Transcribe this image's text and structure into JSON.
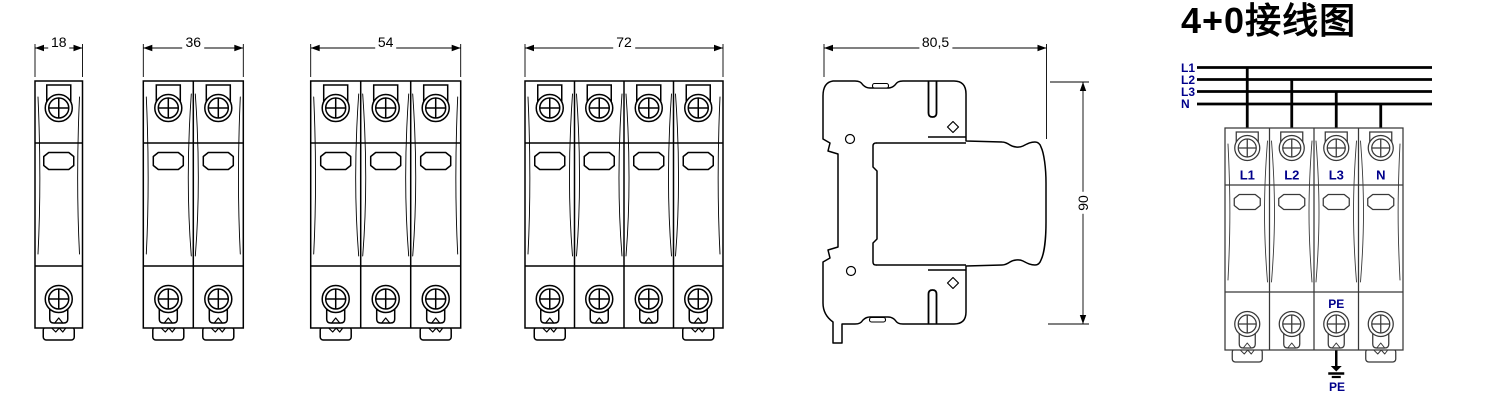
{
  "figure": {
    "front_views": [
      {
        "poles": 1,
        "width_mm": "18"
      },
      {
        "poles": 2,
        "width_mm": "36"
      },
      {
        "poles": 3,
        "width_mm": "54"
      },
      {
        "poles": 4,
        "width_mm": "72"
      }
    ],
    "side_view": {
      "width_mm": "80,5",
      "height_mm": "90"
    },
    "wiring_diagram": {
      "title": "4+0接线图",
      "bus_labels": [
        "L1",
        "L2",
        "L3",
        "N"
      ],
      "terminal_labels": [
        "L1",
        "L2",
        "L3",
        "N"
      ],
      "pe_label_top": "PE",
      "pe_label_bottom": "PE"
    },
    "colors": {
      "line": "#000000",
      "wiring_device_line": "#383838",
      "label_blue": "#00008B"
    }
  }
}
